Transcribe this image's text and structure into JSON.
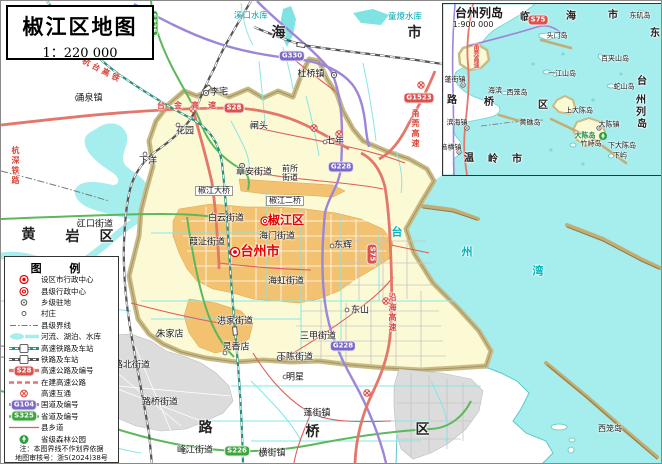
{
  "map": {
    "title": "椒江区地图",
    "scale": "1：220 000"
  },
  "colors": {
    "sea": "#a6eded",
    "district_fill": "#fcfad4",
    "boundary_band": "#c9ba85",
    "urban_orange": "#f3c271",
    "urban_gray": "#dcdcdc",
    "expressway": "#e4776b",
    "national_road": "#9d85d8",
    "provincial_road": "#5cb85c",
    "county_road": "#e05b5b",
    "hsr": "#2a8f7f",
    "railway": "#555555",
    "admin_red": "#e60000",
    "water_label": "#00a8b0"
  },
  "labels": [
    {
      "t": "临",
      "x": 148,
      "y": 30,
      "c": "region"
    },
    {
      "t": "海",
      "x": 278,
      "y": 32,
      "c": "region"
    },
    {
      "t": "市",
      "x": 414,
      "y": 32,
      "c": "region"
    },
    {
      "t": "黄",
      "x": 28,
      "y": 234,
      "c": "region"
    },
    {
      "t": "岩",
      "x": 72,
      "y": 236,
      "c": "region"
    },
    {
      "t": "区",
      "x": 106,
      "y": 236,
      "c": "region"
    },
    {
      "t": "路",
      "x": 205,
      "y": 427,
      "c": "region"
    },
    {
      "t": "桥",
      "x": 312,
      "y": 431,
      "c": "region"
    },
    {
      "t": "区",
      "x": 422,
      "y": 429,
      "c": "region"
    },
    {
      "t": "台州市",
      "x": 259,
      "y": 251,
      "c": "city-red"
    },
    {
      "t": "椒江区",
      "x": 285,
      "y": 219,
      "c": "district-red"
    },
    {
      "t": "涌泉镇",
      "x": 88,
      "y": 98
    },
    {
      "t": "杜桥镇",
      "x": 310,
      "y": 74
    },
    {
      "t": "李宅",
      "x": 218,
      "y": 92
    },
    {
      "t": "花园",
      "x": 184,
      "y": 131
    },
    {
      "t": "闸头",
      "x": 258,
      "y": 126
    },
    {
      "t": "七年",
      "x": 334,
      "y": 141
    },
    {
      "t": "章安街道",
      "x": 253,
      "y": 172
    },
    {
      "t": "前所",
      "x": 289,
      "y": 168,
      "c": "small"
    },
    {
      "t": "街道",
      "x": 289,
      "y": 177,
      "c": "small"
    },
    {
      "t": "下洋",
      "x": 147,
      "y": 161
    },
    {
      "t": "江口街道",
      "x": 94,
      "y": 224
    },
    {
      "t": "白云街道",
      "x": 225,
      "y": 218
    },
    {
      "t": "海门街道",
      "x": 276,
      "y": 236
    },
    {
      "t": "葭沚街道",
      "x": 206,
      "y": 242
    },
    {
      "t": "海虹街道",
      "x": 285,
      "y": 281
    },
    {
      "t": "东辉",
      "x": 342,
      "y": 245
    },
    {
      "t": "东山",
      "x": 359,
      "y": 310
    },
    {
      "t": "三甲街道",
      "x": 317,
      "y": 336
    },
    {
      "t": "下陈街道",
      "x": 294,
      "y": 357
    },
    {
      "t": "明星",
      "x": 294,
      "y": 377
    },
    {
      "t": "洪家街道",
      "x": 234,
      "y": 321
    },
    {
      "t": "朱家店",
      "x": 169,
      "y": 334
    },
    {
      "t": "灵香店",
      "x": 235,
      "y": 347
    },
    {
      "t": "路北街道",
      "x": 131,
      "y": 365
    },
    {
      "t": "路桥街道",
      "x": 159,
      "y": 402
    },
    {
      "t": "峰江街道",
      "x": 194,
      "y": 450
    },
    {
      "t": "横街镇",
      "x": 271,
      "y": 453
    },
    {
      "t": "蓬街镇",
      "x": 316,
      "y": 413
    },
    {
      "t": "椒江大桥",
      "x": 213,
      "y": 190,
      "c": "bridge"
    },
    {
      "t": "椒江二桥",
      "x": 284,
      "y": 200,
      "c": "bridge"
    },
    {
      "t": "溪口水库",
      "x": 250,
      "y": 15,
      "c": "water"
    },
    {
      "t": "童燎水库",
      "x": 404,
      "y": 16,
      "c": "water"
    },
    {
      "t": "台",
      "x": 396,
      "y": 231,
      "c": "water-lg"
    },
    {
      "t": "州",
      "x": 466,
      "y": 251,
      "c": "water-lg"
    },
    {
      "t": "湾",
      "x": 537,
      "y": 270,
      "c": "water-lg"
    },
    {
      "t": "西笼岛",
      "x": 609,
      "y": 428,
      "c": "small"
    },
    {
      "t": "杭台高铁",
      "x": 101,
      "y": 70,
      "c": "road-red rot28"
    },
    {
      "t": "台金高速",
      "x": 190,
      "y": 105,
      "c": "road-red sp"
    },
    {
      "t": "甬莞高速",
      "x": 414,
      "y": 128,
      "c": "road-red vert"
    },
    {
      "t": "沿海高速",
      "x": 391,
      "y": 312,
      "c": "road-red vert"
    },
    {
      "t": "杭深铁路",
      "x": 14,
      "y": 165,
      "c": "road-red vert"
    }
  ],
  "badges": [
    {
      "t": "S28",
      "x": 233,
      "y": 107,
      "c": "expwy"
    },
    {
      "t": "G1523",
      "x": 418,
      "y": 97,
      "c": "expwy"
    },
    {
      "t": "S75",
      "x": 371,
      "y": 253,
      "c": "expwy vert"
    },
    {
      "t": "G330",
      "x": 291,
      "y": 55,
      "c": "national"
    },
    {
      "t": "G228",
      "x": 340,
      "y": 166,
      "c": "national"
    },
    {
      "t": "G228",
      "x": 342,
      "y": 345,
      "c": "national"
    },
    {
      "t": "S325",
      "x": 152,
      "y": 22,
      "c": "provincial vert"
    },
    {
      "t": "S226",
      "x": 236,
      "y": 450,
      "c": "provincial"
    }
  ],
  "inset": {
    "title": "台州列岛",
    "scale": "1:900 000",
    "labels": [
      {
        "t": "临",
        "x": 82,
        "y": 14,
        "c": "region-sm"
      },
      {
        "t": "海",
        "x": 128,
        "y": 13,
        "c": "region-sm"
      },
      {
        "t": "市",
        "x": 170,
        "y": 12,
        "c": "region-sm"
      },
      {
        "t": "东",
        "x": 212,
        "y": 30,
        "c": "region-sm"
      },
      {
        "t": "台",
        "x": 199,
        "y": 78,
        "c": "region-sm"
      },
      {
        "t": "州",
        "x": 198,
        "y": 97,
        "c": "region-sm"
      },
      {
        "t": "列",
        "x": 198,
        "y": 109,
        "c": "region-sm"
      },
      {
        "t": "岛",
        "x": 199,
        "y": 121,
        "c": "region-sm"
      },
      {
        "t": "温",
        "x": 26,
        "y": 155,
        "c": "region-sm"
      },
      {
        "t": "岭",
        "x": 50,
        "y": 156,
        "c": "region-sm"
      },
      {
        "t": "市",
        "x": 74,
        "y": 156,
        "c": "region-sm"
      },
      {
        "t": "路",
        "x": 9,
        "y": 97,
        "c": "region-sm"
      },
      {
        "t": "桥",
        "x": 46,
        "y": 99,
        "c": "region-sm"
      },
      {
        "t": "区",
        "x": 100,
        "y": 102,
        "c": "region-sm"
      },
      {
        "t": "东矶岛",
        "x": 197,
        "y": 12,
        "c": "isl"
      },
      {
        "t": "头门岛",
        "x": 114,
        "y": 32,
        "c": "isl"
      },
      {
        "t": "百夹山岛",
        "x": 172,
        "y": 55,
        "c": "isl"
      },
      {
        "t": "一江山岛",
        "x": 119,
        "y": 70,
        "c": "isl"
      },
      {
        "t": "蛇山岛",
        "x": 181,
        "y": 83,
        "c": "isl"
      },
      {
        "t": "上大陈岛",
        "x": 136,
        "y": 107,
        "c": "isl"
      },
      {
        "t": "大陈镇",
        "x": 166,
        "y": 121,
        "c": "isl"
      },
      {
        "t": "大陈岛",
        "x": 142,
        "y": 132,
        "c": "green"
      },
      {
        "t": "竹峙岛",
        "x": 148,
        "y": 140,
        "c": "isl"
      },
      {
        "t": "下大陈岛",
        "x": 179,
        "y": 142,
        "c": "isl"
      },
      {
        "t": "下屿",
        "x": 177,
        "y": 152,
        "c": "isl"
      },
      {
        "t": "黄礁岛",
        "x": 87,
        "y": 119,
        "c": "isl"
      },
      {
        "t": "西笼岛",
        "x": 74,
        "y": 89,
        "c": "isl"
      },
      {
        "t": "海滨",
        "x": 52,
        "y": 87,
        "c": "isl"
      },
      {
        "t": "蓬街镇",
        "x": 12,
        "y": 76,
        "c": "isl"
      },
      {
        "t": "滨海镇",
        "x": 14,
        "y": 119,
        "c": "isl"
      },
      {
        "t": "箬横镇",
        "x": 8,
        "y": 144,
        "c": "isl"
      },
      {
        "t": "甬莞高速",
        "x": 32,
        "y": 52,
        "c": "road-red vert insm"
      }
    ],
    "badges": [
      {
        "t": "S75",
        "x": 95,
        "y": 16,
        "c": "expwy"
      }
    ]
  },
  "legend": {
    "title": "图    例",
    "items": [
      {
        "sym": "city",
        "label": "设区市行政中心"
      },
      {
        "sym": "county",
        "label": "县级行政中心"
      },
      {
        "sym": "township",
        "label": "乡级驻地"
      },
      {
        "sym": "village",
        "label": "村庄"
      },
      {
        "sym": "boundary",
        "label": "县级界线"
      },
      {
        "sym": "water",
        "label": "河流、湖泊、水库"
      },
      {
        "sym": "hsr",
        "label": "高速铁路及车站"
      },
      {
        "sym": "rail",
        "label": "铁路及车站"
      },
      {
        "sym": "expwy",
        "label": "高速公路及编号",
        "badge": "S28"
      },
      {
        "sym": "expwy-uc",
        "label": "在建高速公路"
      },
      {
        "sym": "interchange",
        "label": "高速互通"
      },
      {
        "sym": "national",
        "label": "国道及编号",
        "badge": "G104"
      },
      {
        "sym": "provincial",
        "label": "省道及编号",
        "badge": "S325"
      },
      {
        "sym": "county-road",
        "label": "县乡道"
      },
      {
        "sym": "forest",
        "label": "省级森林公园"
      }
    ],
    "notes": [
      "注：本图界线不作划界依据",
      "地图审核号：浙S(2024)38号"
    ]
  }
}
